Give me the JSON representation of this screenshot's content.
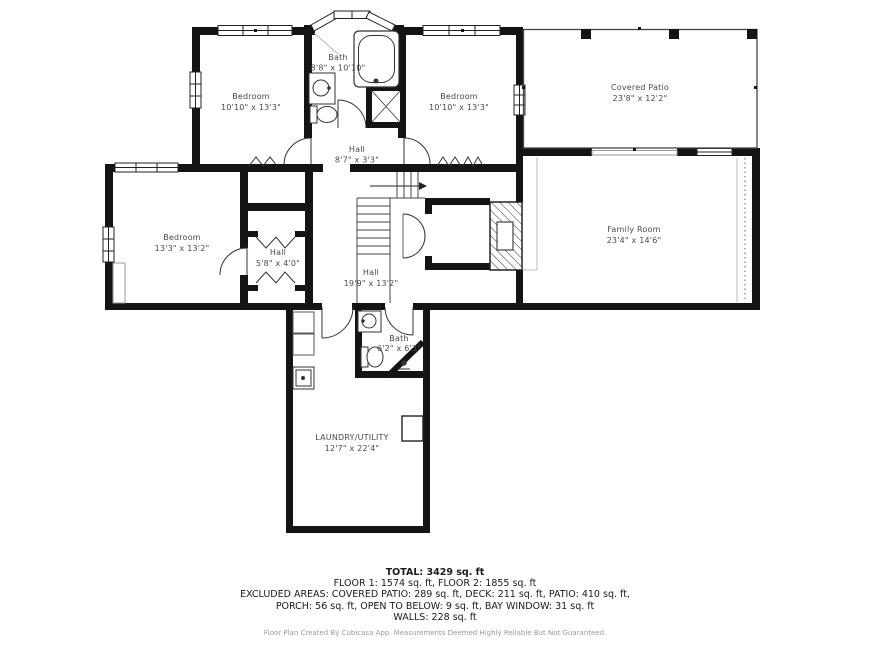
{
  "plan": {
    "rooms": [
      {
        "id": "bath-upper",
        "name": "Bath",
        "dims": "8'8\" x 10'10\""
      },
      {
        "id": "bedroom-top-left",
        "name": "Bedroom",
        "dims": "10'10\" x 13'3\""
      },
      {
        "id": "bedroom-top-right",
        "name": "Bedroom",
        "dims": "10'10\" x 13'3\""
      },
      {
        "id": "covered-patio",
        "name": "Covered Patio",
        "dims": "23'8\" x 12'2\""
      },
      {
        "id": "hall-upper",
        "name": "Hall",
        "dims": "8'7\" x 3'3\""
      },
      {
        "id": "bedroom-left",
        "name": "Bedroom",
        "dims": "13'3\" x 13'2\""
      },
      {
        "id": "hall-small",
        "name": "Hall",
        "dims": "5'8\" x 4'0\""
      },
      {
        "id": "hall-main",
        "name": "Hall",
        "dims": "19'9\" x 13'2\""
      },
      {
        "id": "family-room",
        "name": "Family Room",
        "dims": "23'4\" x 14'6\""
      },
      {
        "id": "bath-lower",
        "name": "Bath",
        "dims": "6'2\" x 6'3\""
      },
      {
        "id": "laundry",
        "name": "LAUNDRY/UTILITY",
        "dims": "12'7\" x 22'4\""
      }
    ]
  },
  "summary": {
    "total": "TOTAL: 3429 sq. ft",
    "line1": "FLOOR 1: 1574 sq. ft, FLOOR 2: 1855 sq. ft",
    "line2": "EXCLUDED AREAS: COVERED PATIO: 289 sq. ft, DECK: 211 sq. ft, PATIO: 410 sq. ft,",
    "line3": "PORCH: 56 sq. ft, OPEN TO BELOW: 9 sq. ft, BAY WINDOW: 31 sq. ft",
    "line4": "WALLS: 228 sq. ft"
  },
  "footer": "Floor Plan Created By Cubicasa App. Measurements Deemed Highly Reliable But Not Guaranteed.",
  "colors": {
    "wall": "#141414",
    "label": "#4a4a4a",
    "text": "#1a1a1a",
    "footer": "#9a9a9a"
  }
}
